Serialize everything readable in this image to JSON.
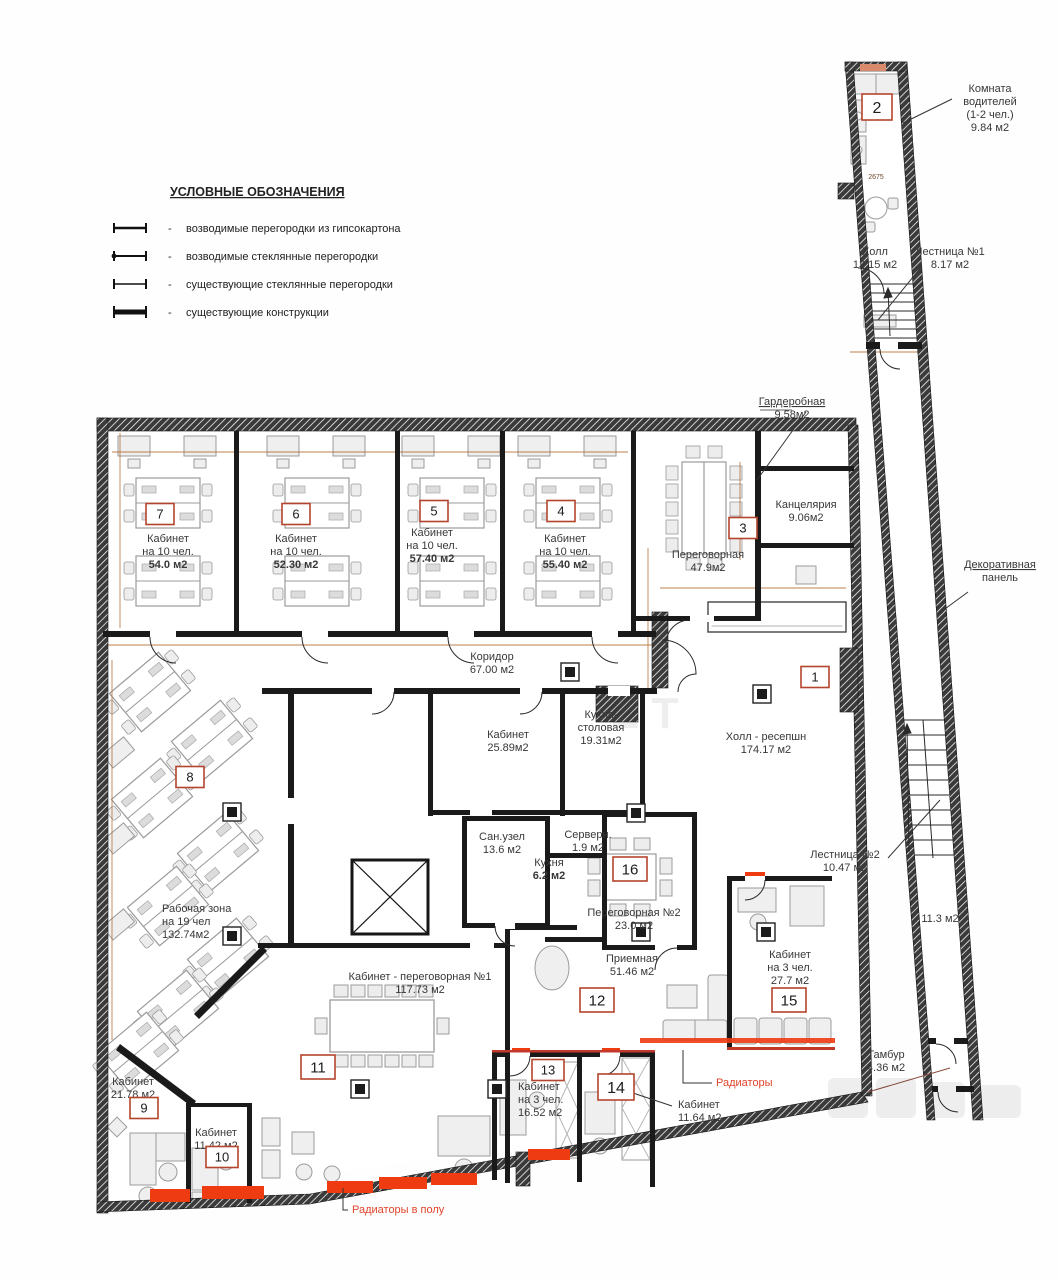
{
  "legend": {
    "title": "УСЛОВНЫЕ ОБОЗНАЧЕНИЯ",
    "dash": "-",
    "items": [
      {
        "id": "gypsum-new",
        "text": "возводимые перегородки из гипсокартона"
      },
      {
        "id": "glass-new",
        "text": "возводимые стеклянные перегородки"
      },
      {
        "id": "glass-existing",
        "text": "существующие стеклянные перегородки"
      },
      {
        "id": "existing-structures",
        "text": "существующие конструкции"
      }
    ]
  },
  "plan": {
    "colors": {
      "wall": "#1a1a1a",
      "marker_border": "#b5442c",
      "radiator": "#ee3b12",
      "red_label": "#e0442a",
      "dim_line": "#b06a2f",
      "text": "#383838"
    },
    "watermark": {
      "center": "Е Т"
    },
    "labels": [
      {
        "id": "driver-room",
        "x": 990,
        "y": 92,
        "lines": [
          "Комната",
          "водителей",
          "(1-2 чел.)",
          "9.84 м2"
        ]
      },
      {
        "id": "hall-1",
        "x": 875,
        "y": 255,
        "lines": [
          "Холл",
          "13.15 м2"
        ]
      },
      {
        "id": "stairs-1",
        "x": 950,
        "y": 255,
        "lines": [
          "Лестница №1",
          "8.17 м2"
        ]
      },
      {
        "id": "wardrobe",
        "x": 792,
        "y": 405,
        "underline_first": true,
        "lines": [
          "Гардеробная",
          "9.58м2"
        ]
      },
      {
        "id": "chancellery",
        "x": 806,
        "y": 508,
        "lines": [
          "Канцелярия",
          "9.06м2"
        ]
      },
      {
        "id": "office-7",
        "x": 168,
        "y": 542,
        "bold_last": true,
        "lines": [
          "Кабинет",
          "на 10 чел.",
          "54.0 м2"
        ]
      },
      {
        "id": "office-6",
        "x": 296,
        "y": 542,
        "bold_last": true,
        "lines": [
          "Кабинет",
          "на 10 чел.",
          "52.30 м2"
        ]
      },
      {
        "id": "office-5",
        "x": 432,
        "y": 536,
        "bold_last": true,
        "lines": [
          "Кабинет",
          "на 10 чел.",
          "57.40 м2"
        ]
      },
      {
        "id": "office-4",
        "x": 565,
        "y": 542,
        "bold_last": true,
        "lines": [
          "Кабинет",
          "на 10 чел.",
          "55.40 м2"
        ]
      },
      {
        "id": "meeting-3",
        "x": 708,
        "y": 558,
        "lines": [
          "Переговорная",
          "47.9м2"
        ]
      },
      {
        "id": "corridor",
        "x": 492,
        "y": 660,
        "lines": [
          "Коридор",
          "67.00 м2"
        ]
      },
      {
        "id": "office-2589",
        "x": 508,
        "y": 738,
        "lines": [
          "Кабинет",
          "25.89м2"
        ]
      },
      {
        "id": "kitchen-dining",
        "x": 601,
        "y": 718,
        "lines": [
          "Кухня-",
          "столовая",
          "19.31м2"
        ]
      },
      {
        "id": "hall-reception",
        "x": 766,
        "y": 740,
        "lines": [
          "Холл - ресепшн",
          "174.17 м2"
        ]
      },
      {
        "id": "bathroom",
        "x": 502,
        "y": 840,
        "lines": [
          "Сан.узел",
          "13.6 м2"
        ]
      },
      {
        "id": "server",
        "x": 588,
        "y": 838,
        "lines": [
          "Серверн.",
          "1.9 м2"
        ]
      },
      {
        "id": "kitchen",
        "x": 549,
        "y": 866,
        "bold_last": true,
        "lines": [
          "Кухня",
          "6.2 м2"
        ]
      },
      {
        "id": "meeting-2",
        "x": 634,
        "y": 916,
        "lines": [
          "Переговорная №2",
          "23.0 м2"
        ]
      },
      {
        "id": "work-zone",
        "x": 162,
        "y": 912,
        "anchor": "start",
        "lines": [
          "Рабочая зона",
          "на 19 чел",
          "132.74м2"
        ]
      },
      {
        "id": "office-2178",
        "x": 133,
        "y": 1085,
        "lines": [
          "Кабинет",
          "21.78 м2"
        ]
      },
      {
        "id": "office-1142",
        "x": 216,
        "y": 1136,
        "lines": [
          "Кабинет",
          "11.42 м2"
        ]
      },
      {
        "id": "office-meeting-1",
        "x": 420,
        "y": 980,
        "lines": [
          "Кабинет - переговорная №1",
          "117.73 м2"
        ]
      },
      {
        "id": "reception-room",
        "x": 632,
        "y": 962,
        "lines": [
          "Приемная",
          "51.46 м2"
        ]
      },
      {
        "id": "office-277",
        "x": 790,
        "y": 958,
        "lines": [
          "Кабинет",
          "на 3 чел.",
          "27.7 м2"
        ]
      },
      {
        "id": "office-1652",
        "x": 518,
        "y": 1090,
        "anchor": "start",
        "lines": [
          "Кабинет",
          "на 3 чел.",
          "16.52 м2"
        ]
      },
      {
        "id": "office-1164",
        "x": 678,
        "y": 1108,
        "anchor": "start",
        "lines": [
          "Кабинет",
          "11.64 м2"
        ]
      },
      {
        "id": "stairs-2",
        "x": 845,
        "y": 858,
        "lines": [
          "Лестница №2",
          "10.47 м2"
        ]
      },
      {
        "id": "area-113",
        "x": 940,
        "y": 922,
        "lines": [
          "11.3 м2"
        ]
      },
      {
        "id": "tambour",
        "x": 886,
        "y": 1058,
        "lines": [
          "Тамбур",
          "4.36 м2"
        ]
      },
      {
        "id": "decor-panel",
        "x": 1000,
        "y": 568,
        "underline_first": true,
        "lines": [
          "Декоративная",
          "панель"
        ]
      },
      {
        "id": "radiators",
        "x": 716,
        "y": 1086,
        "anchor": "start",
        "color": "#e0442a",
        "lines": [
          "Радиаторы"
        ]
      },
      {
        "id": "radiators-floor",
        "x": 352,
        "y": 1213,
        "anchor": "start",
        "color": "#e0442a",
        "lines": [
          "Радиаторы в полу"
        ]
      }
    ],
    "markers": [
      {
        "n": "2",
        "x": 877,
        "y": 107,
        "w": 30,
        "h": 26,
        "fs": 16
      },
      {
        "n": "7",
        "x": 160,
        "y": 514
      },
      {
        "n": "6",
        "x": 296,
        "y": 514
      },
      {
        "n": "5",
        "x": 434,
        "y": 511
      },
      {
        "n": "4",
        "x": 561,
        "y": 511
      },
      {
        "n": "3",
        "x": 743,
        "y": 528
      },
      {
        "n": "1",
        "x": 815,
        "y": 677
      },
      {
        "n": "16",
        "x": 630,
        "y": 869,
        "w": 34,
        "h": 24,
        "fs": 15
      },
      {
        "n": "8",
        "x": 190,
        "y": 777
      },
      {
        "n": "9",
        "x": 144,
        "y": 1108
      },
      {
        "n": "10",
        "x": 222,
        "y": 1157,
        "w": 32
      },
      {
        "n": "11",
        "x": 318,
        "y": 1067,
        "w": 34,
        "h": 24,
        "fs": 15
      },
      {
        "n": "12",
        "x": 597,
        "y": 1000,
        "w": 34,
        "h": 24,
        "fs": 15
      },
      {
        "n": "13",
        "x": 548,
        "y": 1070,
        "w": 32
      },
      {
        "n": "14",
        "x": 616,
        "y": 1087,
        "w": 36,
        "h": 26,
        "fs": 16
      },
      {
        "n": "15",
        "x": 789,
        "y": 1000,
        "w": 34,
        "h": 24,
        "fs": 15
      }
    ],
    "dims": [
      {
        "text": "2675",
        "x": 876,
        "y": 179
      }
    ]
  }
}
